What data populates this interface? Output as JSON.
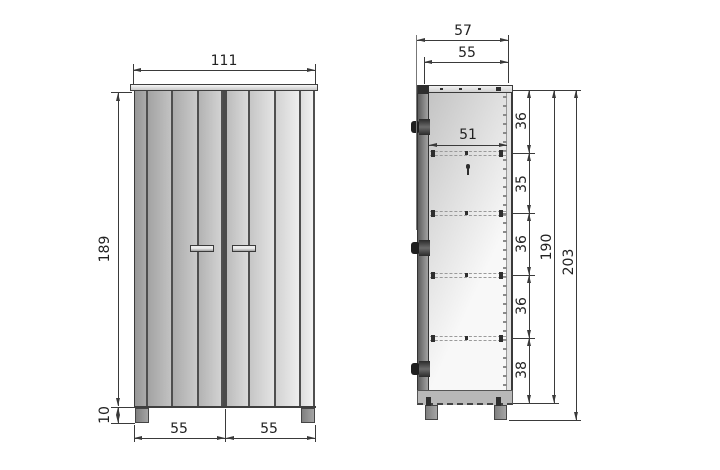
{
  "drawing": {
    "front_view": {
      "overall_width": "111",
      "body_height": "189",
      "leg_height": "10",
      "left_door_width": "55",
      "right_door_width": "55"
    },
    "side_view": {
      "overall_depth": "57",
      "top_depth": "55",
      "shelf_depth": "51",
      "sections": [
        "36",
        "35",
        "36",
        "36",
        "38"
      ],
      "interior_height": "190",
      "overall_height": "203"
    }
  },
  "colors": {
    "line": "#3a3a3a",
    "panel_dark": "#9a9a9a",
    "panel_light": "#f0f0f0",
    "background": "#ffffff"
  }
}
